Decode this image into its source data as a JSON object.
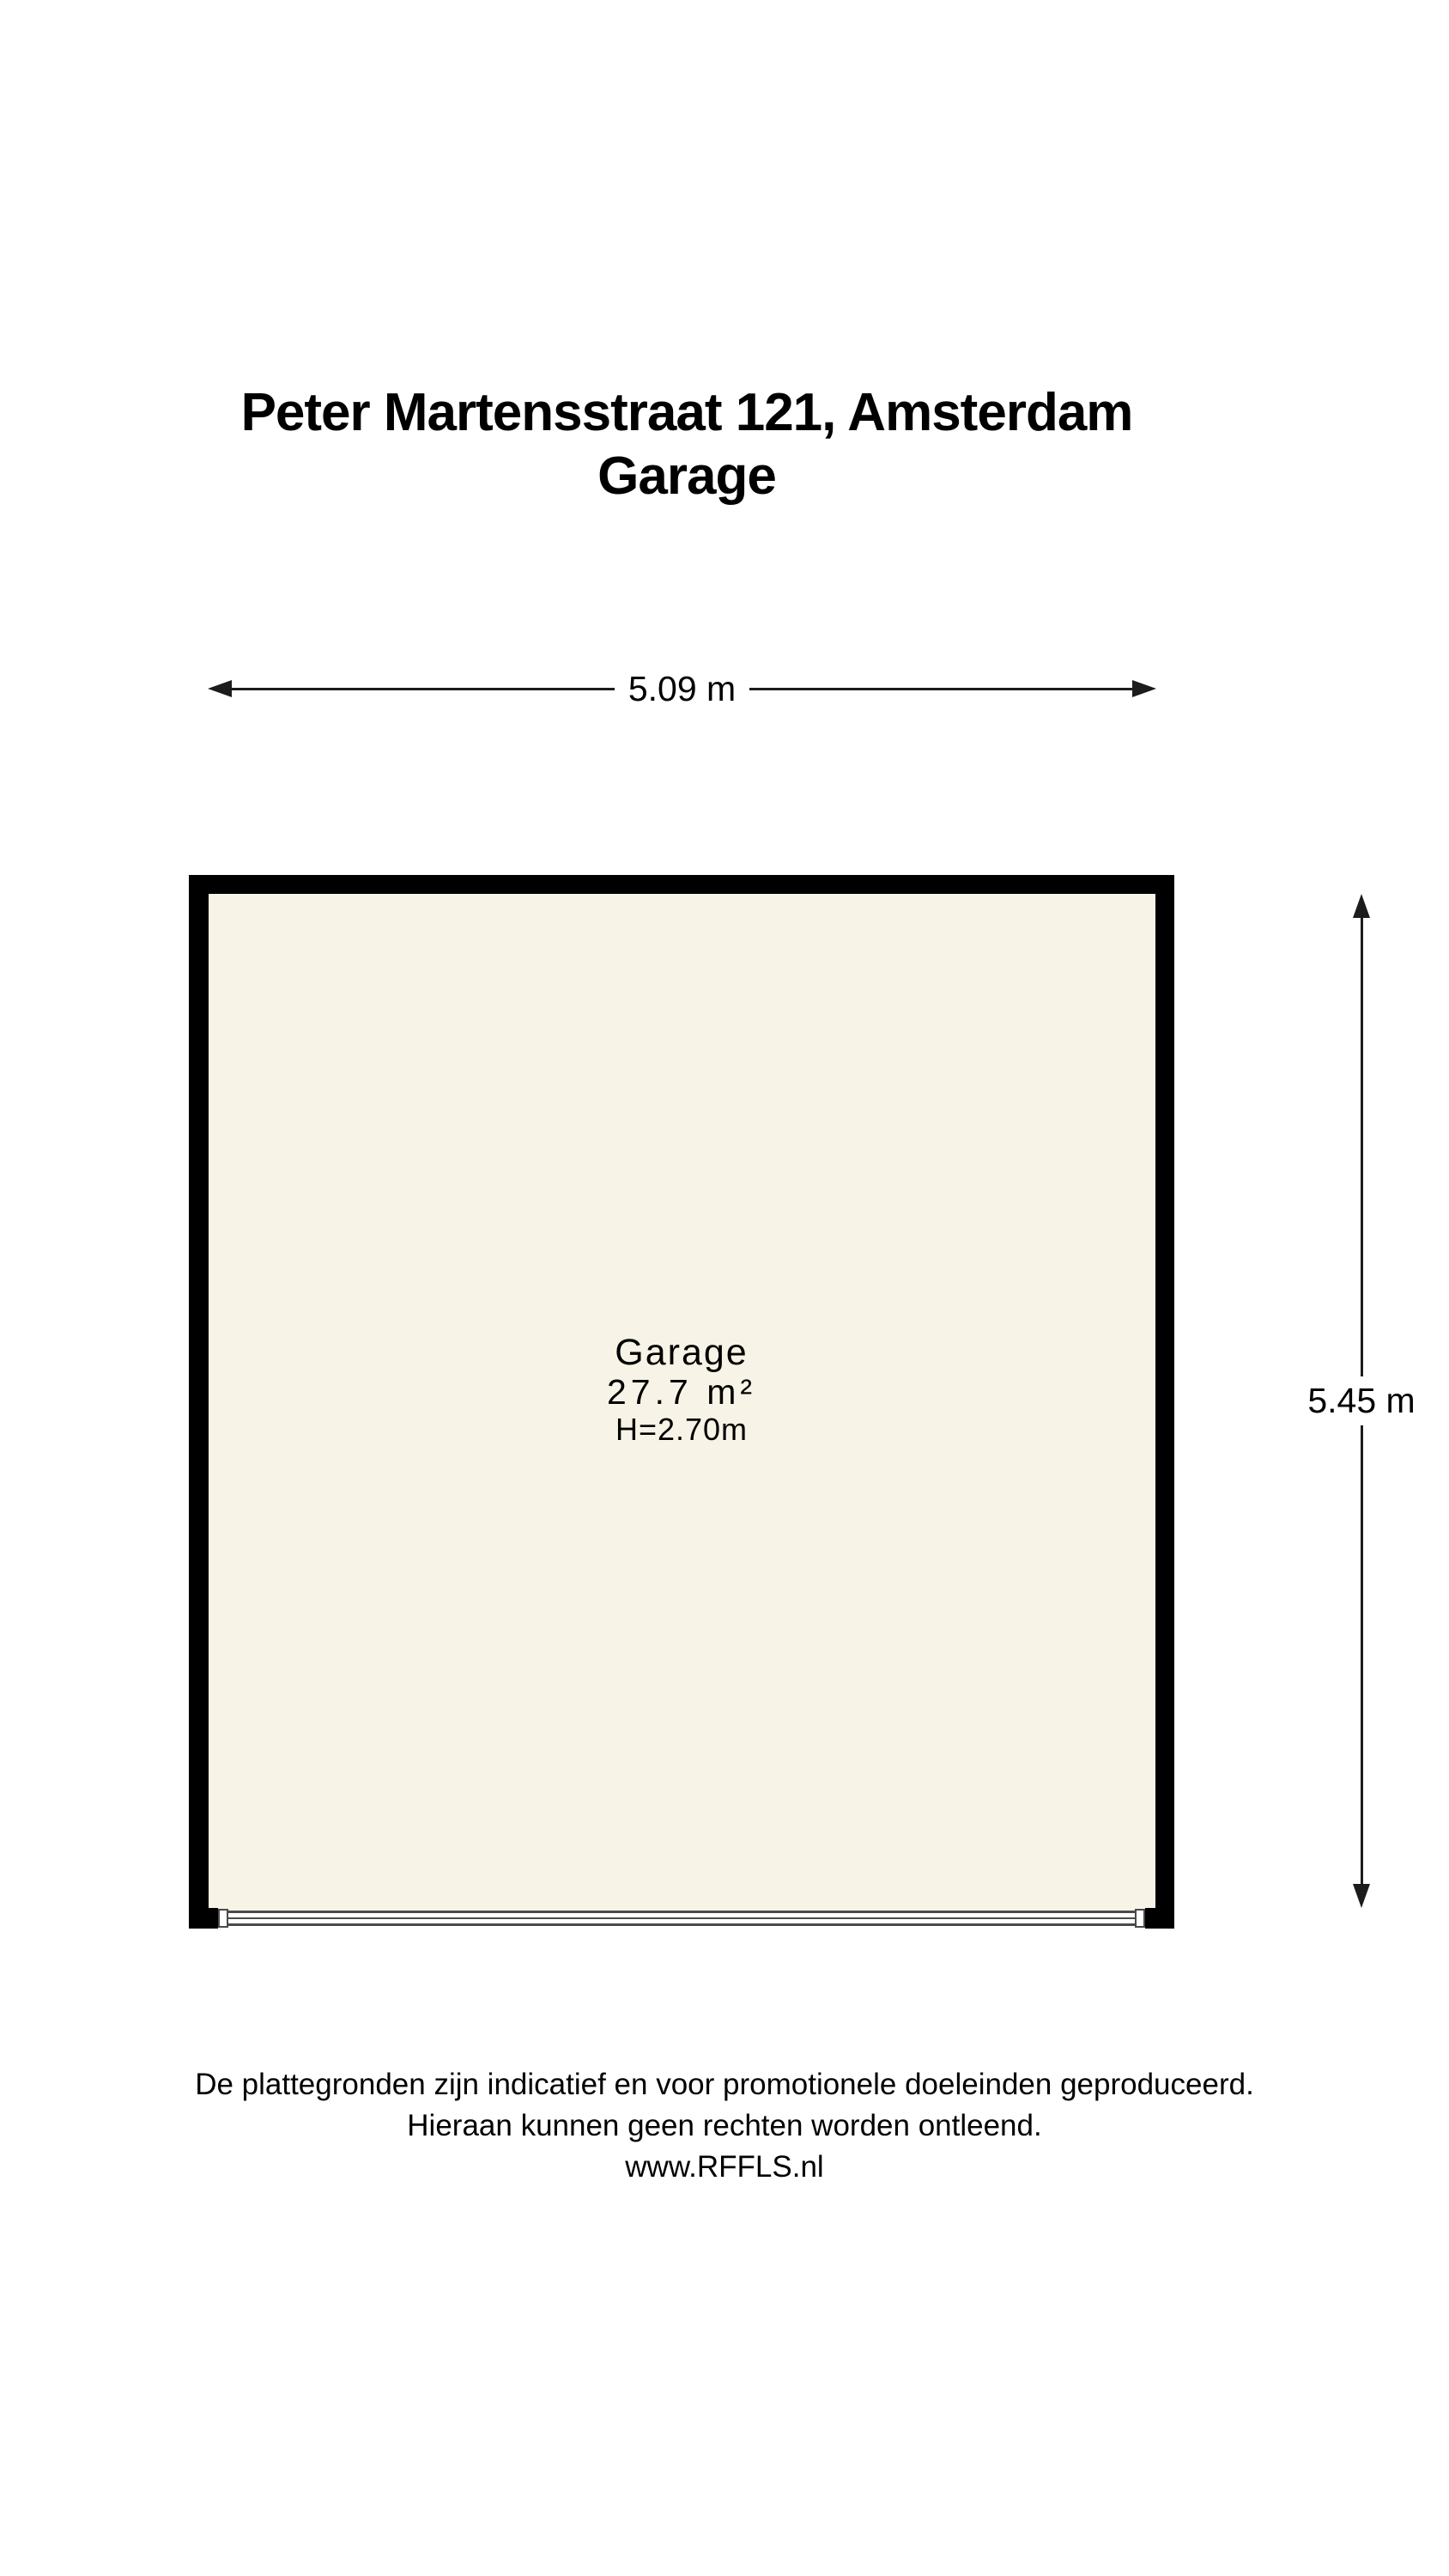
{
  "title": {
    "address": "Peter Martensstraat 121, Amsterdam",
    "room": "Garage"
  },
  "dimensions": {
    "width_label": "5.09 m",
    "height_label": "5.45 m"
  },
  "room": {
    "name": "Garage",
    "area": "27.7 m²",
    "ceiling_height": "H=2.70m"
  },
  "footer": {
    "line1": "De plattegronden zijn indicatief en voor promotionele doeleinden geproduceerd.",
    "line2": "Hieraan kunnen geen rechten worden ontleend.",
    "line3": "www.RFFLS.nl"
  },
  "colors": {
    "floor": "#f7f3e6",
    "wall": "#000000",
    "door_line": "#4a4a4a",
    "dim_line": "#1c1c1c",
    "text": "#000000"
  }
}
